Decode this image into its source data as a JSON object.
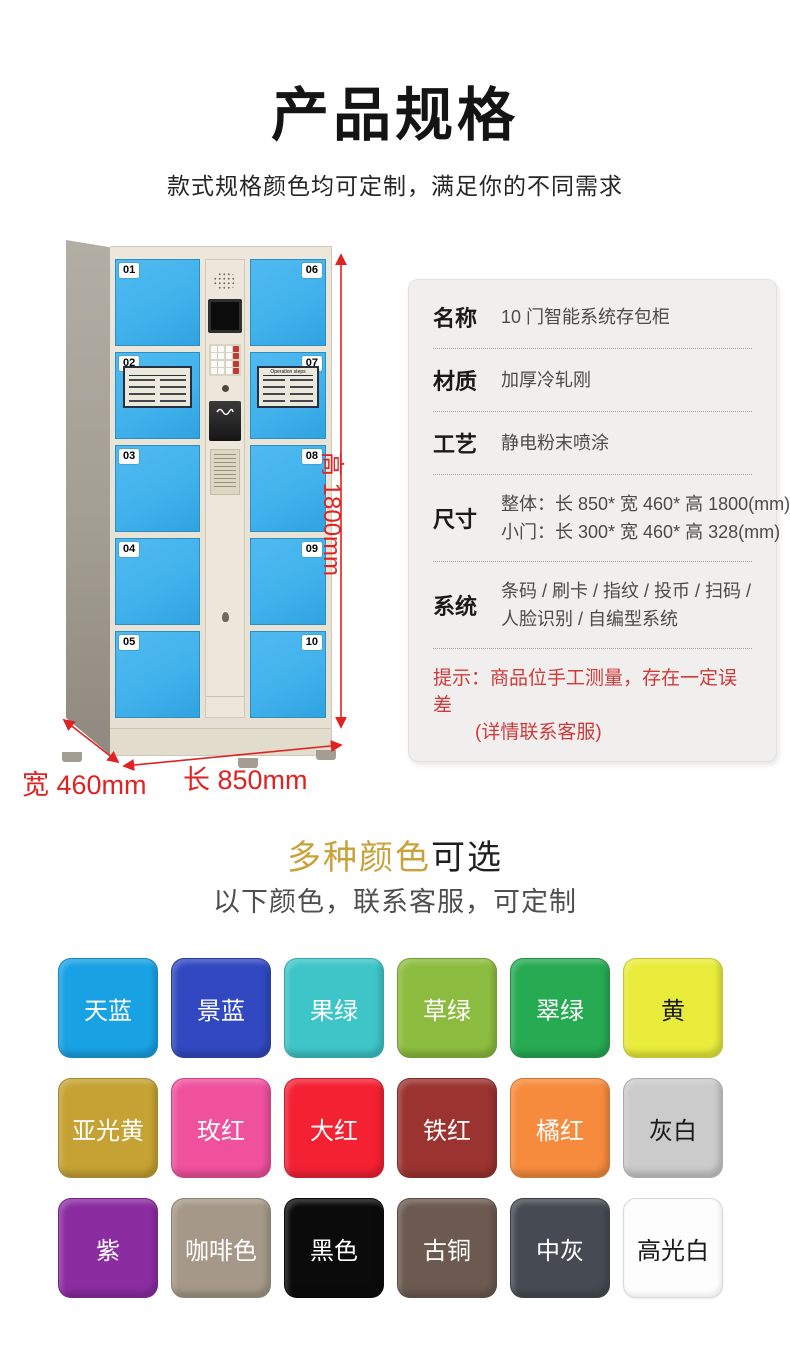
{
  "page": {
    "title": "产品规格",
    "subtitle": "款式规格颜色均可定制，满足你的不同需求"
  },
  "locker": {
    "left_door_numbers": [
      "01",
      "02",
      "03",
      "04",
      "05"
    ],
    "right_door_numbers": [
      "06",
      "07",
      "08",
      "09",
      "10"
    ],
    "placards": {
      "left_title": "",
      "right_title": "Operation steps"
    },
    "dimensions": {
      "height_label": "高 1800mm",
      "width_label": "宽 460mm",
      "length_label": "长 850mm"
    },
    "colors": {
      "door_blue": "#42b2ec",
      "cabinet_cream": "#eae5d9",
      "dimension_red": "#e02222"
    }
  },
  "specs": {
    "rows": [
      {
        "label": "名称",
        "lines": [
          "10 门智能系统存包柜"
        ]
      },
      {
        "label": "材质",
        "lines": [
          "加厚冷轧刚"
        ]
      },
      {
        "label": "工艺",
        "lines": [
          "静电粉末喷涂"
        ]
      },
      {
        "label": "尺寸",
        "lines": [
          "整体：长 850* 宽 460* 高 1800(mm)",
          "小门：长 300* 宽 460* 高 328(mm)"
        ]
      },
      {
        "label": "系统",
        "lines": [
          "条码 / 刷卡 / 指纹 / 投币 / 扫码 /",
          "人脸识别 / 自编型系统"
        ]
      }
    ],
    "note": {
      "line1": "提示：商品位手工测量，存在一定误差",
      "line2": "(详情联系客服)",
      "color": "#cf3a3a"
    }
  },
  "colors_section": {
    "heading_highlight": "多种颜色",
    "heading_rest": "可选",
    "heading_highlight_color": "#c8a23b",
    "subtitle": "以下颜色，联系客服，可定制",
    "swatches": [
      {
        "label": "天蓝",
        "hex": "#18a2e4",
        "text": "#ffffff"
      },
      {
        "label": "景蓝",
        "hex": "#3148c0",
        "text": "#ffffff"
      },
      {
        "label": "果绿",
        "hex": "#3ec5c8",
        "text": "#ffffff"
      },
      {
        "label": "草绿",
        "hex": "#8cbc3f",
        "text": "#ffffff"
      },
      {
        "label": "翠绿",
        "hex": "#27ab52",
        "text": "#ffffff"
      },
      {
        "label": "黄",
        "hex": "#e9ec3a",
        "text": "#1a1a1a"
      },
      {
        "label": "亚光黄",
        "hex": "#c5a233",
        "text": "#ffffff"
      },
      {
        "label": "玫红",
        "hex": "#ef519c",
        "text": "#ffffff"
      },
      {
        "label": "大红",
        "hex": "#f42133",
        "text": "#ffffff"
      },
      {
        "label": "铁红",
        "hex": "#9b3330",
        "text": "#ffffff"
      },
      {
        "label": "橘红",
        "hex": "#f78b3d",
        "text": "#ffffff"
      },
      {
        "label": "灰白",
        "hex": "#cbcbcb",
        "text": "#1a1a1a"
      },
      {
        "label": "紫",
        "hex": "#8b2da1",
        "text": "#ffffff"
      },
      {
        "label": "咖啡色",
        "hex": "#a59888",
        "text": "#ffffff"
      },
      {
        "label": "黑色",
        "hex": "#0b0b0b",
        "text": "#ffffff"
      },
      {
        "label": "古铜",
        "hex": "#6c5a50",
        "text": "#ffffff"
      },
      {
        "label": "中灰",
        "hex": "#464b53",
        "text": "#ffffff"
      },
      {
        "label": "高光白",
        "hex": "#fdfdfd",
        "text": "#1a1a1a"
      }
    ]
  }
}
